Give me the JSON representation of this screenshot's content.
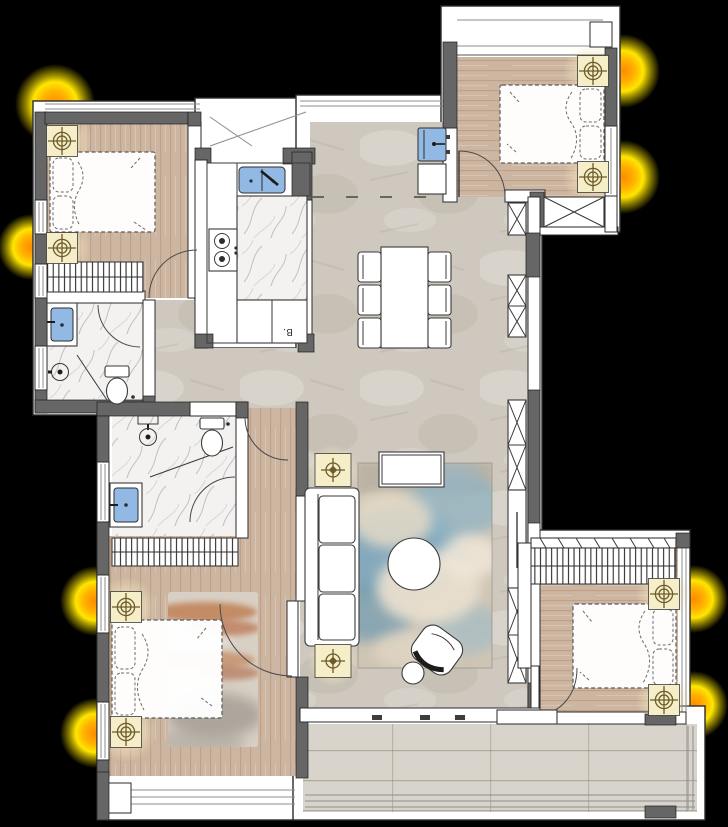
{
  "scene": {
    "type": "residential apartment floor plan, top-down rendered drawing",
    "background": "#000000"
  },
  "text": {
    "kitchen_cabinet_label": "B."
  },
  "palette": {
    "outline": "#2b2b2b",
    "wall": "#666666",
    "white": "#ffffff",
    "wood": "#cdb6a1",
    "wood_shade": "#bda189",
    "tile": "#cec8be",
    "tile_balcony": "#d8d4cb",
    "marble": "#f3f2f1",
    "fixture_blue": "#92b9e4",
    "symbol_bg": "#f6edc9",
    "symbol_ink": "#6b5c28",
    "glow_orange": "#ff8a00",
    "glow_yellow": "#ffe600",
    "rug_blue": "#7ea7bd",
    "rug_cream": "#e9dfce",
    "rug_rust": "#c08055",
    "rug_gray": "#8f8a83"
  },
  "legend_symbols": [
    {
      "name": "ceiling-light-symbol",
      "glyph": "double-circle crosshair on pale yellow pad",
      "count": 8
    },
    {
      "name": "floor-lamp-symbol",
      "glyph": "diamond crosshair on pale yellow pad",
      "count": 2
    },
    {
      "name": "window-glow",
      "glyph": "radial yellow-orange sunlight burst",
      "count": 8
    }
  ],
  "rooms": [
    {
      "name": "bedroom-top-left",
      "floor": "wood"
    },
    {
      "name": "bathroom-top-left",
      "floor": "marble"
    },
    {
      "name": "kitchen",
      "floor": "white with marble island"
    },
    {
      "name": "entry-utility",
      "floor": "tile"
    },
    {
      "name": "bedroom-top-right",
      "floor": "wood"
    },
    {
      "name": "dining-area",
      "floor": "tile"
    },
    {
      "name": "hallway",
      "floor": "tile"
    },
    {
      "name": "master-bathroom",
      "floor": "marble"
    },
    {
      "name": "master-bedroom",
      "floor": "wood"
    },
    {
      "name": "living-room",
      "floor": "tile with cloud rug"
    },
    {
      "name": "bedroom-bottom-right",
      "floor": "wood"
    },
    {
      "name": "balcony",
      "floor": "large tile"
    }
  ],
  "furniture": [
    "double bed x4 (dashed outline with pillows)",
    "nightstand with ceiling-light symbol x8",
    "wardrobe hatched strip x3",
    "dining table with 6 chairs",
    "sofa with chaise",
    "coffee table",
    "round side table",
    "lounge chair",
    "round stool",
    "storage cabinets with X cross x6",
    "kitchen double sink",
    "two-burner stove",
    "kitchen island (marble)",
    "base cabinet labeled B.",
    "washer / utility sink",
    "bathroom sink x3",
    "toilet x2",
    "shower head symbol x2",
    "area rug x2"
  ]
}
